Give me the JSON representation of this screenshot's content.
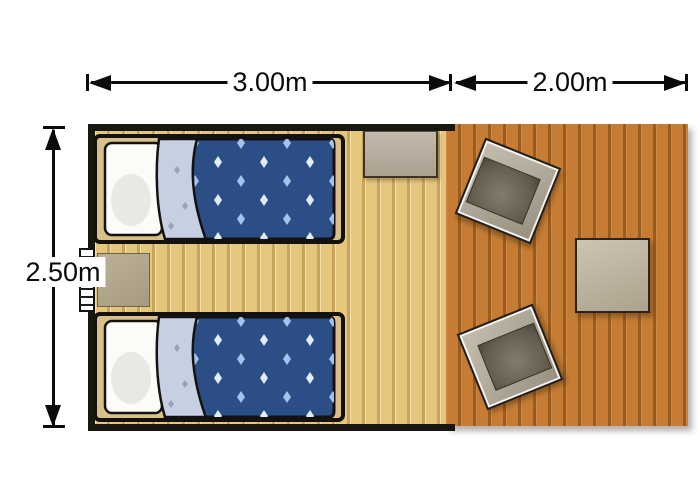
{
  "dimensions": {
    "bedroom_width_label": "3.00m",
    "deck_width_label": "2.00m",
    "room_depth_label": "2.50m"
  },
  "rooms": {
    "bedroom": {
      "furniture": [
        "single-bed",
        "single-bed",
        "bedside-table",
        "side-table",
        "entrance-steps"
      ]
    },
    "deck": {
      "furniture": [
        "armchair",
        "armchair",
        "coffee-table"
      ]
    }
  },
  "colors": {
    "dim": "#0b0b0b",
    "wall": "#1a1611",
    "bedroom-floor": "#e4c77c",
    "bedroom-floor-line": "#c8a458",
    "deck": "#c67d33",
    "deck-line": "#9a5b1e",
    "outline": "#141210",
    "bed-frame": "#d9bf8a",
    "pillow": "#fbfbf8",
    "sheet": "#c7d0e2",
    "sheet-dot": "#9aa3b5",
    "duvet": "#2c4e86",
    "duvet-diamond": "#a3c2ec",
    "duvet-diamond-alt": "#e2ecf8"
  }
}
